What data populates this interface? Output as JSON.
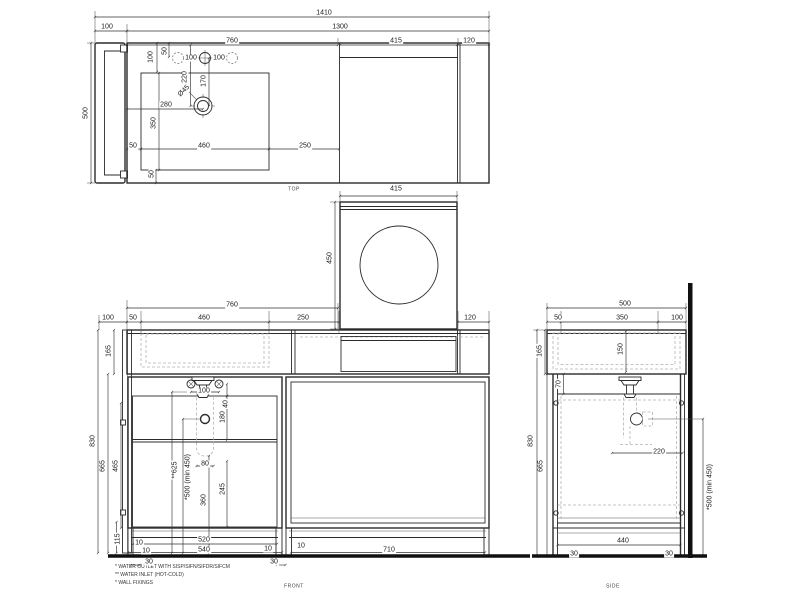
{
  "drawing": {
    "views": [
      {
        "id": "top",
        "label": "TOP"
      },
      {
        "id": "front",
        "label": "FRONT"
      },
      {
        "id": "side",
        "label": "SIDE"
      }
    ],
    "footnotes": [
      "* WATER OUTLET WITH SISP/SIFN/SIFDR/SIFCM",
      "** WATER INLET  (HOT-COLD)",
      "* WALL FIXINGS"
    ],
    "colors": {
      "line": "#2b2b2b",
      "dashed": "#b3b3b3",
      "background": "#ffffff"
    },
    "dim_labels": [
      {
        "t": "1410",
        "x": 324,
        "y": 13,
        "r": 0
      },
      {
        "t": "100",
        "x": 107,
        "y": 27,
        "r": 0
      },
      {
        "t": "1300",
        "x": 340,
        "y": 27,
        "r": 0
      },
      {
        "t": "760",
        "x": 232,
        "y": 41,
        "r": 0
      },
      {
        "t": "415",
        "x": 396,
        "y": 41,
        "r": 0
      },
      {
        "t": "120",
        "x": 469,
        "y": 41,
        "r": 0
      },
      {
        "t": "500",
        "x": 86,
        "y": 113,
        "r": -90
      },
      {
        "t": "100",
        "x": 151,
        "y": 57,
        "r": -90
      },
      {
        "t": "50",
        "x": 165,
        "y": 51,
        "r": -90
      },
      {
        "t": "100",
        "x": 191,
        "y": 58,
        "r": 0
      },
      {
        "t": "100",
        "x": 219,
        "y": 58,
        "r": 0
      },
      {
        "t": "220",
        "x": 185,
        "y": 77,
        "r": -90
      },
      {
        "t": "170",
        "x": 204,
        "y": 81,
        "r": -90
      },
      {
        "t": "Ø45",
        "x": 184,
        "y": 91,
        "r": -45
      },
      {
        "t": "280",
        "x": 166,
        "y": 105,
        "r": 0
      },
      {
        "t": "350",
        "x": 154,
        "y": 123,
        "r": -90
      },
      {
        "t": "50",
        "x": 133,
        "y": 146,
        "r": 0
      },
      {
        "t": "460",
        "x": 204,
        "y": 146,
        "r": 0
      },
      {
        "t": "250",
        "x": 305,
        "y": 146,
        "r": 0
      },
      {
        "t": "50",
        "x": 152,
        "y": 174,
        "r": -90
      },
      {
        "t": "415",
        "x": 396,
        "y": 189,
        "r": 0
      },
      {
        "t": "450",
        "x": 330,
        "y": 258,
        "r": -90
      },
      {
        "t": "760",
        "x": 232,
        "y": 305,
        "r": 0
      },
      {
        "t": "100",
        "x": 108,
        "y": 318,
        "r": 0
      },
      {
        "t": "50",
        "x": 133,
        "y": 318,
        "r": 0
      },
      {
        "t": "460",
        "x": 204,
        "y": 318,
        "r": 0
      },
      {
        "t": "250",
        "x": 303,
        "y": 318,
        "r": 0
      },
      {
        "t": "120",
        "x": 470,
        "y": 318,
        "r": 0
      },
      {
        "t": "165",
        "x": 109,
        "y": 351,
        "r": -90
      },
      {
        "t": "830",
        "x": 93,
        "y": 441,
        "r": -90
      },
      {
        "t": "665",
        "x": 103,
        "y": 466,
        "r": -90
      },
      {
        "t": "465",
        "x": 116,
        "y": 466,
        "r": -90
      },
      {
        "t": "115",
        "x": 118,
        "y": 539,
        "r": -90
      },
      {
        "t": "100",
        "x": 204,
        "y": 391,
        "r": 0
      },
      {
        "t": "40",
        "x": 226,
        "y": 404,
        "r": -90
      },
      {
        "t": "180",
        "x": 223,
        "y": 417,
        "r": -90
      },
      {
        "t": "80",
        "x": 205,
        "y": 464,
        "r": 0
      },
      {
        "t": "245",
        "x": 223,
        "y": 489,
        "r": -90
      },
      {
        "t": "360",
        "x": 204,
        "y": 500,
        "r": -90
      },
      {
        "t": "*500 (min 450)",
        "x": 188,
        "y": 477,
        "r": -90
      },
      {
        "t": "**625",
        "x": 175,
        "y": 470,
        "r": -90
      },
      {
        "t": "10",
        "x": 139,
        "y": 543,
        "r": 0
      },
      {
        "t": "10",
        "x": 146,
        "y": 551,
        "r": 0
      },
      {
        "t": "30",
        "x": 149,
        "y": 562,
        "r": 0
      },
      {
        "t": "520",
        "x": 204,
        "y": 540,
        "r": 0
      },
      {
        "t": "540",
        "x": 204,
        "y": 550,
        "r": 0
      },
      {
        "t": "10",
        "x": 268,
        "y": 549,
        "r": 0
      },
      {
        "t": "30",
        "x": 274,
        "y": 562,
        "r": 0
      },
      {
        "t": "10",
        "x": 301,
        "y": 546,
        "r": 0
      },
      {
        "t": "710",
        "x": 389,
        "y": 550,
        "r": 0
      },
      {
        "t": "500",
        "x": 625,
        "y": 304,
        "r": 0
      },
      {
        "t": "50",
        "x": 558,
        "y": 318,
        "r": 0
      },
      {
        "t": "350",
        "x": 622,
        "y": 318,
        "r": 0
      },
      {
        "t": "100",
        "x": 677,
        "y": 318,
        "r": 0
      },
      {
        "t": "165",
        "x": 540,
        "y": 351,
        "r": -90
      },
      {
        "t": "150",
        "x": 621,
        "y": 349,
        "r": -90
      },
      {
        "t": "830",
        "x": 531,
        "y": 441,
        "r": -90
      },
      {
        "t": "665",
        "x": 541,
        "y": 466,
        "r": -90
      },
      {
        "t": "70",
        "x": 559,
        "y": 384,
        "r": -90
      },
      {
        "t": "220",
        "x": 659,
        "y": 452,
        "r": 0
      },
      {
        "t": "*500 (min 450)",
        "x": 710,
        "y": 487,
        "r": -90
      },
      {
        "t": "440",
        "x": 623,
        "y": 541,
        "r": 0
      },
      {
        "t": "30",
        "x": 574,
        "y": 554,
        "r": 0
      },
      {
        "t": "30",
        "x": 669,
        "y": 554,
        "r": 0
      }
    ]
  }
}
